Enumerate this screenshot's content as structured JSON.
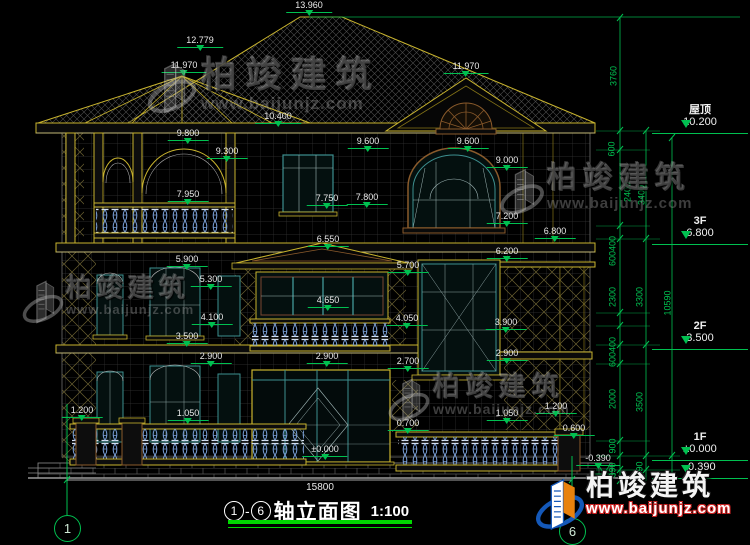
{
  "drawing": {
    "title": {
      "axis_start": "1",
      "axis_end": "6",
      "name": "轴立面图",
      "scale": "1:100"
    },
    "overall_width_dim": "15800",
    "axis_bubbles": {
      "left": "1",
      "right": "6"
    }
  },
  "elevations": [
    {
      "label": "屋顶",
      "value": "10.200"
    },
    {
      "label": "3F",
      "value": "6.800"
    },
    {
      "label": "2F",
      "value": "3.500"
    },
    {
      "label": "1F",
      "value": "±0.000",
      "value2": "-0.390"
    }
  ],
  "annotations": [
    {
      "text": "13.960",
      "x": 309,
      "y": 12
    },
    {
      "text": "12.779",
      "x": 200,
      "y": 47
    },
    {
      "text": "11.970",
      "x": 184,
      "y": 72
    },
    {
      "text": "11.970",
      "x": 466,
      "y": 73
    },
    {
      "text": "10.400",
      "x": 278,
      "y": 123
    },
    {
      "text": "9.800",
      "x": 188,
      "y": 140
    },
    {
      "text": "9.300",
      "x": 227,
      "y": 158
    },
    {
      "text": "9.600",
      "x": 368,
      "y": 148
    },
    {
      "text": "9.600",
      "x": 468,
      "y": 148
    },
    {
      "text": "9.000",
      "x": 507,
      "y": 167
    },
    {
      "text": "7.950",
      "x": 188,
      "y": 201
    },
    {
      "text": "7.750",
      "x": 327,
      "y": 205
    },
    {
      "text": "7.800",
      "x": 367,
      "y": 204
    },
    {
      "text": "7.200",
      "x": 507,
      "y": 223
    },
    {
      "text": "6.800",
      "x": 555,
      "y": 238
    },
    {
      "text": "6.550",
      "x": 328,
      "y": 246
    },
    {
      "text": "6.200",
      "x": 507,
      "y": 258
    },
    {
      "text": "5.900",
      "x": 187,
      "y": 266
    },
    {
      "text": "5.700",
      "x": 408,
      "y": 272
    },
    {
      "text": "5.300",
      "x": 211,
      "y": 286
    },
    {
      "text": "4.650",
      "x": 328,
      "y": 307
    },
    {
      "text": "4.100",
      "x": 212,
      "y": 324
    },
    {
      "text": "4.050",
      "x": 407,
      "y": 325
    },
    {
      "text": "3.900",
      "x": 506,
      "y": 329
    },
    {
      "text": "3.500",
      "x": 187,
      "y": 343
    },
    {
      "text": "2.900",
      "x": 211,
      "y": 363
    },
    {
      "text": "2.900",
      "x": 327,
      "y": 363
    },
    {
      "text": "2.900",
      "x": 507,
      "y": 360
    },
    {
      "text": "2.700",
      "x": 408,
      "y": 368
    },
    {
      "text": "1.200",
      "x": 82,
      "y": 417
    },
    {
      "text": "1.050",
      "x": 188,
      "y": 420
    },
    {
      "text": "1.050",
      "x": 507,
      "y": 420
    },
    {
      "text": "1.200",
      "x": 556,
      "y": 413
    },
    {
      "text": "0.700",
      "x": 408,
      "y": 430
    },
    {
      "text": "0.600",
      "x": 574,
      "y": 435
    },
    {
      "text": "±0.000",
      "x": 325,
      "y": 456
    },
    {
      "text": "-0.390",
      "x": 598,
      "y": 465
    }
  ],
  "vdims": [
    {
      "text": "3760",
      "x": 614,
      "y": 76
    },
    {
      "text": "600",
      "x": 612,
      "y": 149
    },
    {
      "text": "2400",
      "x": 628,
      "y": 192
    },
    {
      "text": "3400",
      "x": 642,
      "y": 195
    },
    {
      "text": "600400",
      "x": 613,
      "y": 251
    },
    {
      "text": "2300",
      "x": 613,
      "y": 297
    },
    {
      "text": "3300",
      "x": 640,
      "y": 297
    },
    {
      "text": "10590",
      "x": 668,
      "y": 303
    },
    {
      "text": "600400",
      "x": 613,
      "y": 352
    },
    {
      "text": "2000",
      "x": 613,
      "y": 399
    },
    {
      "text": "3500",
      "x": 640,
      "y": 402
    },
    {
      "text": "900",
      "x": 613,
      "y": 446
    },
    {
      "text": "390",
      "x": 613,
      "y": 470
    },
    {
      "text": "390",
      "x": 640,
      "y": 469
    }
  ],
  "watermark": {
    "name": "柏竣建筑",
    "url": "www.baijunjz.com"
  },
  "colors": {
    "line_yellow": "#c9b42e",
    "dim_green": "#00c050",
    "window_teal": "#3d8f8f",
    "trim_brown": "#8a5a2b",
    "baluster_blue": "#7aa0d8",
    "logo_blue": "#1458b8",
    "logo_orange": "#e8820c",
    "background": "#000000"
  }
}
